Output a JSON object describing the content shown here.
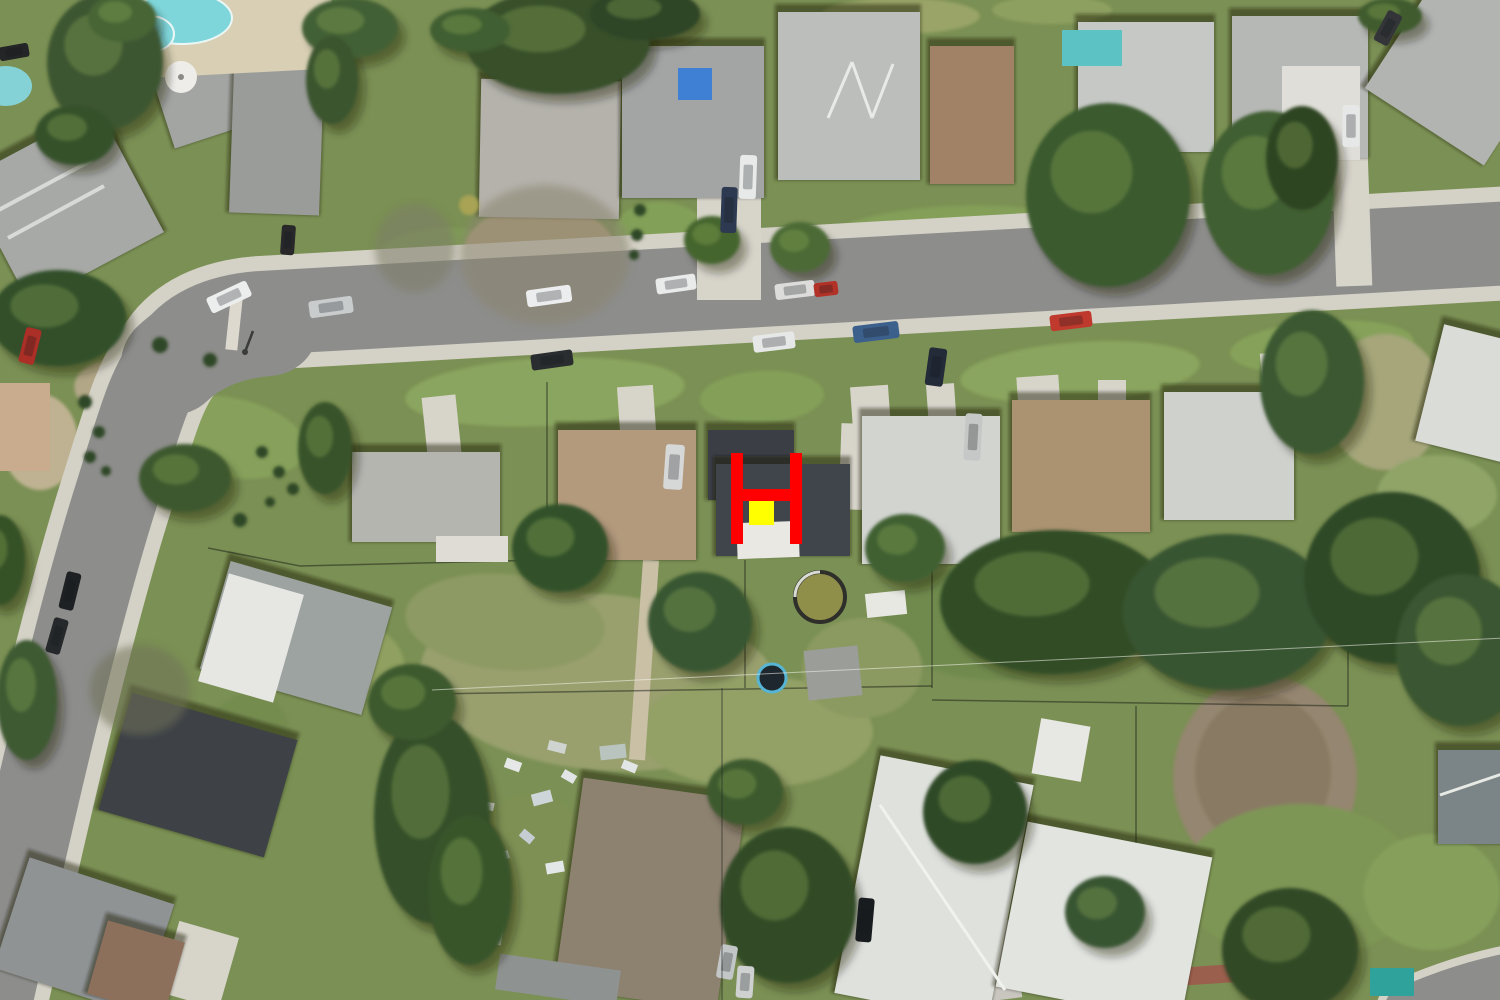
{
  "scene": {
    "type": "aerial-satellite-photo",
    "subject": "suburban residential neighborhood with curved street and landing-zone marker overlay"
  },
  "palette": {
    "grass_base": "#7b9054",
    "asphalt": "#8d8d8b",
    "sidewalk": "#d4d1c6",
    "concrete": "#d7d4ca",
    "marker_red": "#ff0000",
    "marker_yellow": "#ffff00",
    "pool_water": "#7fd6da",
    "roof_charcoal": "#3e434a",
    "roof_gray": "#b4b4b0",
    "roof_tan": "#ab9271",
    "tree_green": "#36522b"
  },
  "marker": {
    "shape": "H",
    "color": "#ff0000",
    "bars": [
      [
        731,
        453,
        12,
        91
      ],
      [
        790,
        453,
        12,
        91
      ],
      [
        731,
        489,
        71,
        12
      ]
    ],
    "square": {
      "x": 749,
      "y": 501,
      "w": 25,
      "h": 24,
      "color": "#ffff00"
    }
  },
  "roads": {
    "main_path": "M -12,1012 C 18,880 70,640 118,490 C 140,420 150,382 172,356 Q 196,318 260,313 L 1512,243",
    "corner_bulge": "M 172,364 Q 208,330 268,325",
    "corner_arc_br": "M 1408,1010 Q 1462,986 1515,976",
    "asphalt_width": 84,
    "sidewalk_width": 114,
    "bulge_width": 102
  },
  "ground_patches": [
    [
      225,
      437,
      82,
      40,
      10,
      "#87a15c"
    ],
    [
      545,
      392,
      140,
      34,
      -3,
      "#8aa55e"
    ],
    [
      762,
      397,
      62,
      26,
      -3,
      "#84a058"
    ],
    [
      1080,
      372,
      120,
      30,
      -4,
      "#8aa55e"
    ],
    [
      1322,
      347,
      92,
      26,
      -4,
      "#86a25a"
    ],
    [
      440,
      252,
      62,
      24,
      -4,
      "#7f9a56"
    ],
    [
      950,
      232,
      120,
      26,
      -3,
      "#839f58"
    ],
    [
      1392,
      217,
      80,
      20,
      -3,
      "#87a15c"
    ],
    [
      900,
      16,
      80,
      18,
      0,
      "#9aa468"
    ],
    [
      1052,
      10,
      60,
      14,
      0,
      "#8ea060"
    ],
    [
      600,
      682,
      180,
      88,
      5,
      "#99a06e"
    ],
    [
      505,
      622,
      100,
      48,
      5,
      "#8d9a64"
    ],
    [
      755,
      732,
      118,
      56,
      0,
      "#93a066"
    ],
    [
      1265,
      778,
      92,
      102,
      0,
      "#94866f"
    ],
    [
      1263,
      772,
      68,
      78,
      0,
      "#897a64"
    ],
    [
      1385,
      402,
      58,
      68,
      0,
      "#a6a67a"
    ],
    [
      1300,
      882,
      118,
      78,
      0,
      "#7e9655"
    ],
    [
      1432,
      892,
      68,
      58,
      0,
      "#86a05c"
    ],
    [
      532,
      882,
      66,
      88,
      0,
      "#7e9053"
    ],
    [
      1000,
      622,
      118,
      58,
      0,
      "#6f8a4e"
    ],
    [
      132,
      392,
      58,
      33,
      8,
      "#b2a787"
    ],
    [
      40,
      442,
      38,
      48,
      0,
      "#bfb292"
    ],
    [
      345,
      658,
      60,
      40,
      12,
      "#8fa061"
    ],
    [
      862,
      668,
      60,
      50,
      0,
      "#8b9a60"
    ],
    [
      240,
      770,
      50,
      80,
      15,
      "#758c4f"
    ],
    [
      90,
      560,
      40,
      60,
      10,
      "#7e9454"
    ],
    [
      1437,
      495,
      60,
      40,
      0,
      "#90a468"
    ],
    [
      540,
      250,
      75,
      45,
      0,
      "#b3a07c"
    ],
    [
      660,
      230,
      45,
      28,
      0,
      "#83a058"
    ]
  ],
  "driveways": [
    [
      697,
      196,
      64,
      104,
      0
    ],
    [
      1334,
      154,
      36,
      132,
      -2
    ],
    [
      425,
      396,
      34,
      68,
      -6
    ],
    [
      619,
      386,
      36,
      60,
      -4
    ],
    [
      852,
      386,
      38,
      58,
      -4
    ],
    [
      928,
      384,
      28,
      58,
      -4
    ],
    [
      1018,
      376,
      42,
      50,
      -4
    ],
    [
      1098,
      380,
      28,
      152,
      0
    ],
    [
      1262,
      352,
      38,
      52,
      -5
    ],
    [
      840,
      424,
      52,
      86,
      2
    ],
    [
      228,
      298,
      12,
      52,
      6,
      "#ddd9cf"
    ],
    [
      636,
      560,
      16,
      200,
      4,
      "#c9c0a6"
    ],
    [
      878,
      928,
      140,
      78,
      -7,
      "#c8c6be"
    ],
    [
      1150,
      966,
      112,
      18,
      -4,
      "#9b5f4d"
    ],
    [
      168,
      928,
      62,
      74,
      16
    ]
  ],
  "houses": [
    [
      "house-nw-1",
      158,
      42,
      146,
      86,
      -18,
      "#a3a5a2"
    ],
    [
      "house-west-edge",
      -12,
      136,
      152,
      140,
      -28,
      "#a7a9a6"
    ],
    [
      "house-nw-2",
      232,
      42,
      90,
      172,
      2,
      "#9a9c99"
    ],
    [
      "house-n-pebble",
      480,
      80,
      140,
      138,
      1,
      "#b4b2ab"
    ],
    [
      "house-n-tarp",
      622,
      46,
      142,
      152,
      0,
      "#a2a5a4"
    ],
    [
      "house-n-zigzag",
      778,
      12,
      142,
      168,
      0,
      "#bcbebb"
    ],
    [
      "house-n-brown",
      930,
      46,
      84,
      138,
      0,
      "#a28266"
    ],
    [
      "house-n-white1",
      1078,
      22,
      136,
      130,
      0,
      "#c6c8c5"
    ],
    [
      "house-n-white2",
      1232,
      16,
      136,
      142,
      0,
      "#b6b8b5"
    ],
    [
      "house-ne-angled",
      1398,
      -24,
      142,
      164,
      33,
      "#b2b4b1"
    ],
    [
      "house-s-gray",
      352,
      452,
      148,
      90,
      0,
      "#b5b5b0"
    ],
    [
      "house-s-tan",
      558,
      430,
      138,
      130,
      0,
      "#b39a7d"
    ],
    [
      "house-marker-left",
      708,
      430,
      86,
      70,
      0,
      "#3b3f45"
    ],
    [
      "house-marker-main",
      716,
      464,
      134,
      92,
      0,
      "#40454c"
    ],
    [
      "house-s-white",
      862,
      416,
      138,
      148,
      0,
      "#d2d4d0"
    ],
    [
      "house-s-brown",
      1012,
      400,
      138,
      132,
      0,
      "#ab9271"
    ],
    [
      "house-s-white2",
      1164,
      392,
      130,
      128,
      0,
      "#cfd1cd"
    ],
    [
      "house-se-white",
      1428,
      336,
      112,
      120,
      14,
      "#dadcd8"
    ],
    [
      "house-sw-twotone",
      212,
      582,
      168,
      112,
      16,
      "#9da3a1"
    ],
    [
      "house-sw-charcoal",
      112,
      714,
      172,
      122,
      16,
      "#3e4247"
    ],
    [
      "house-sw-corner",
      8,
      878,
      152,
      116,
      18,
      "#8f9394"
    ],
    [
      "house-sw-brownroof",
      96,
      930,
      80,
      76,
      16,
      "#8d705b"
    ],
    [
      "house-s-shingle",
      568,
      788,
      164,
      212,
      8,
      "#8d8170"
    ],
    [
      "house-bottom-white-a",
      856,
      768,
      156,
      242,
      11,
      "#dfe1dd"
    ],
    [
      "house-bottom-white-b",
      1010,
      838,
      188,
      168,
      11,
      "#e2e4e0"
    ],
    [
      "house-e-gable",
      1438,
      750,
      74,
      94,
      0,
      "#7b8487"
    ]
  ],
  "overlays": [
    [
      212,
      582,
      78,
      112,
      16,
      "#e6e6e2"
    ],
    [
      678,
      68,
      34,
      32,
      0,
      "#3f7fd4"
    ],
    [
      737,
      522,
      62,
      36,
      -2,
      "#eae8e2"
    ]
  ],
  "ridges": [
    [
      828,
      118,
      852,
      62,
      "#e8eae8",
      3
    ],
    [
      852,
      62,
      872,
      118,
      "#e8eae8",
      3
    ],
    [
      872,
      118,
      893,
      64,
      "#e8eae8",
      3
    ],
    [
      -5,
      212,
      92,
      160,
      "#d8dad8",
      4
    ],
    [
      8,
      238,
      104,
      186,
      "#d8dad8",
      4
    ],
    [
      1440,
      795,
      1508,
      772,
      "#e8eae6",
      3
    ],
    [
      880,
      805,
      1005,
      990,
      "#f0f2ee",
      3
    ]
  ],
  "structures": [
    [
      436,
      536,
      72,
      26,
      0,
      "#dedcd4"
    ],
    [
      806,
      648,
      54,
      50,
      -6,
      "#9b9d99"
    ],
    [
      866,
      592,
      40,
      24,
      -6,
      "#e8e8e2"
    ],
    [
      462,
      906,
      42,
      36,
      10,
      "#e9e9e5"
    ],
    [
      497,
      962,
      122,
      36,
      8,
      "#8e9290"
    ],
    [
      1036,
      722,
      50,
      56,
      10,
      "#e7e7e3"
    ],
    [
      1282,
      66,
      78,
      94,
      0,
      "#e0ded8"
    ],
    [
      1370,
      968,
      44,
      28,
      0,
      "#2fa39b"
    ],
    [
      0,
      383,
      50,
      88,
      0,
      "#c9ab8e"
    ],
    [
      1062,
      30,
      60,
      36,
      0,
      "#5cc2c4"
    ]
  ],
  "pools": {
    "deck": [
      115,
      -12,
      218,
      86,
      -3,
      "#d8cfb4"
    ],
    "kidney": [
      [
        182,
        18,
        50,
        26
      ],
      [
        150,
        34,
        24,
        18
      ]
    ],
    "kidney_color": "#7fd6da",
    "small_left": [
      6,
      86,
      26,
      20
    ],
    "small_left_color": "#84d2d6",
    "round_pool": {
      "cx": 820,
      "cy": 597,
      "r": 25,
      "water": "#8f8f4a",
      "rim": "#2e2e2a"
    },
    "trampoline": {
      "cx": 772,
      "cy": 678,
      "r": 14,
      "mat": "#1d272d",
      "ring": "#56b4d4"
    },
    "umbrella": {
      "cx": 181,
      "cy": 77,
      "r": 16,
      "color": "#efede9"
    }
  },
  "trees": [
    [
      105,
      62,
      58,
      68,
      "#3d5730"
    ],
    [
      122,
      18,
      34,
      24,
      "#466534"
    ],
    [
      75,
      135,
      40,
      30,
      "#36512b"
    ],
    [
      350,
      28,
      48,
      30,
      "#426035"
    ],
    [
      332,
      80,
      26,
      44,
      "#3a552e"
    ],
    [
      558,
      42,
      92,
      52,
      "#374f2b"
    ],
    [
      645,
      14,
      55,
      26,
      "#2e4526"
    ],
    [
      470,
      30,
      40,
      22,
      "#415f33"
    ],
    [
      712,
      240,
      28,
      24,
      "#45652f"
    ],
    [
      800,
      247,
      30,
      25,
      "#4c6a36"
    ],
    [
      1108,
      195,
      82,
      92,
      "#3a5a2d"
    ],
    [
      1268,
      193,
      66,
      82,
      "#405f31"
    ],
    [
      1302,
      158,
      36,
      52,
      "#2d4524"
    ],
    [
      1390,
      16,
      32,
      18,
      "#3f5c2f"
    ],
    [
      1312,
      382,
      52,
      72,
      "#3b5930"
    ],
    [
      58,
      318,
      68,
      48,
      "#33502a"
    ],
    [
      185,
      478,
      46,
      34,
      "#3c582e"
    ],
    [
      325,
      448,
      27,
      46,
      "#375329"
    ],
    [
      560,
      548,
      48,
      44,
      "#33512a"
    ],
    [
      700,
      622,
      52,
      50,
      "#395631"
    ],
    [
      905,
      548,
      40,
      34,
      "#416032"
    ],
    [
      1055,
      602,
      115,
      72,
      "#314d27"
    ],
    [
      1228,
      612,
      105,
      78,
      "#375430"
    ],
    [
      1392,
      578,
      88,
      86,
      "#2e4827"
    ],
    [
      1462,
      650,
      66,
      76,
      "#3a5730"
    ],
    [
      432,
      818,
      58,
      105,
      "#364f2a"
    ],
    [
      412,
      702,
      44,
      38,
      "#3e5a2e"
    ],
    [
      470,
      890,
      42,
      75,
      "#395429"
    ],
    [
      788,
      905,
      68,
      78,
      "#324c26"
    ],
    [
      745,
      792,
      38,
      33,
      "#3d5a2d"
    ],
    [
      975,
      812,
      52,
      52,
      "#2f4a25"
    ],
    [
      1290,
      950,
      68,
      62,
      "#304a26"
    ],
    [
      1105,
      912,
      40,
      36,
      "#395530"
    ],
    [
      27,
      700,
      30,
      60,
      "#3d5a31"
    ],
    [
      0,
      560,
      25,
      45,
      "#365128"
    ]
  ],
  "bare_trees": [
    [
      545,
      255,
      85,
      70,
      "#8a8570"
    ],
    [
      415,
      248,
      40,
      44,
      "#7d7d68"
    ],
    [
      140,
      690,
      50,
      45,
      "#6f7258"
    ]
  ],
  "shrubs": [
    [
      85,
      402,
      7
    ],
    [
      99,
      432,
      6
    ],
    [
      90,
      457,
      6
    ],
    [
      106,
      471,
      5
    ],
    [
      262,
      452,
      6
    ],
    [
      279,
      472,
      6
    ],
    [
      293,
      489,
      6
    ],
    [
      270,
      502,
      5
    ],
    [
      240,
      520,
      7
    ],
    [
      160,
      345,
      8
    ],
    [
      210,
      360,
      7
    ],
    [
      640,
      210,
      6
    ],
    [
      637,
      235,
      6
    ],
    [
      634,
      255,
      5
    ]
  ],
  "shrub_color": "#2f4726",
  "yellow_bush": [
    469,
    205,
    10,
    "#a8a355"
  ],
  "debris": [
    [
      505,
      760,
      16,
      10,
      20,
      "#e6e8e8"
    ],
    [
      532,
      792,
      20,
      12,
      -15,
      "#cfd6da"
    ],
    [
      562,
      772,
      14,
      9,
      30,
      "#e2e5e6"
    ],
    [
      588,
      802,
      22,
      12,
      10,
      "#9db3c7"
    ],
    [
      612,
      832,
      16,
      10,
      -25,
      "#e8eaea"
    ],
    [
      640,
      852,
      18,
      10,
      15,
      "#d8dde0"
    ],
    [
      520,
      832,
      14,
      9,
      40,
      "#c6cdd2"
    ],
    [
      546,
      862,
      18,
      11,
      -10,
      "#e4e7e8"
    ],
    [
      576,
      892,
      16,
      9,
      25,
      "#d2d8db"
    ],
    [
      602,
      912,
      14,
      9,
      -30,
      "#e6e8e8"
    ],
    [
      482,
      802,
      12,
      8,
      12,
      "#dfe3e4"
    ],
    [
      496,
      852,
      13,
      8,
      -18,
      "#ccd3d8"
    ],
    [
      622,
      762,
      15,
      9,
      22,
      "#e2e5e6"
    ],
    [
      652,
      792,
      13,
      8,
      -12,
      "#d8dde0"
    ],
    [
      714,
      781,
      20,
      12,
      8,
      "#6fc6d8"
    ],
    [
      600,
      745,
      26,
      14,
      -6,
      "#b9c4bf"
    ],
    [
      548,
      742,
      18,
      10,
      14,
      "#cfd4d0"
    ]
  ],
  "cars": [
    [
      229,
      297,
      44,
      17,
      -25,
      "#eceeee"
    ],
    [
      331,
      307,
      44,
      17,
      -8,
      "#c9cccd"
    ],
    [
      549,
      296,
      45,
      17,
      -8,
      "#ecedee"
    ],
    [
      552,
      360,
      42,
      16,
      -8,
      "#2a2d2f"
    ],
    [
      676,
      284,
      40,
      16,
      -8,
      "#e9ebeb"
    ],
    [
      774,
      342,
      42,
      17,
      -7,
      "#e6e8e8"
    ],
    [
      795,
      290,
      40,
      16,
      -7,
      "#dcdcda"
    ],
    [
      826,
      289,
      24,
      14,
      -7,
      "#b23227"
    ],
    [
      876,
      332,
      46,
      17,
      -7,
      "#3c608c"
    ],
    [
      1071,
      321,
      42,
      16,
      -7,
      "#bf392d"
    ],
    [
      748,
      177,
      17,
      44,
      2,
      "#e8eaea"
    ],
    [
      729,
      210,
      16,
      46,
      2,
      "#2d3950"
    ],
    [
      1351,
      126,
      17,
      42,
      0,
      "#e6e8e8"
    ],
    [
      936,
      367,
      18,
      38,
      8,
      "#232a38"
    ],
    [
      674,
      467,
      19,
      45,
      4,
      "#d6d7d7"
    ],
    [
      973,
      437,
      17,
      47,
      3,
      "#c6c8c7"
    ],
    [
      70,
      591,
      15,
      38,
      14,
      "#1e2123"
    ],
    [
      57,
      636,
      15,
      36,
      16,
      "#26292b"
    ],
    [
      30,
      346,
      16,
      36,
      14,
      "#ab2f26"
    ],
    [
      288,
      240,
      14,
      30,
      4,
      "#28282a"
    ],
    [
      727,
      962,
      17,
      34,
      10,
      "#c3c6c6"
    ],
    [
      745,
      982,
      17,
      32,
      4,
      "#cfd1d1"
    ],
    [
      865,
      920,
      16,
      44,
      5,
      "#191c1e"
    ],
    [
      14,
      52,
      30,
      14,
      -10,
      "#232526"
    ],
    [
      1388,
      28,
      16,
      34,
      28,
      "#333538"
    ]
  ],
  "fences": [
    [
      300,
      566,
      545,
      560
    ],
    [
      547,
      382,
      547,
      560
    ],
    [
      430,
      694,
      932,
      686
    ],
    [
      932,
      560,
      932,
      688
    ],
    [
      932,
      700,
      1348,
      706
    ],
    [
      1136,
      706,
      1136,
      848
    ],
    [
      745,
      560,
      745,
      688
    ],
    [
      208,
      548,
      300,
      566
    ],
    [
      1348,
      640,
      1348,
      706
    ]
  ],
  "powerlines": [
    [
      432,
      690,
      1505,
      638,
      "rgba(245,245,238,0.55)",
      1
    ],
    [
      722,
      688,
      722,
      1002,
      "rgba(40,42,38,0.45)",
      1.5
    ]
  ],
  "lamp": {
    "x1": 245,
    "y1": 352,
    "x2": 253,
    "y2": 331,
    "color": "#3a3c3a"
  }
}
